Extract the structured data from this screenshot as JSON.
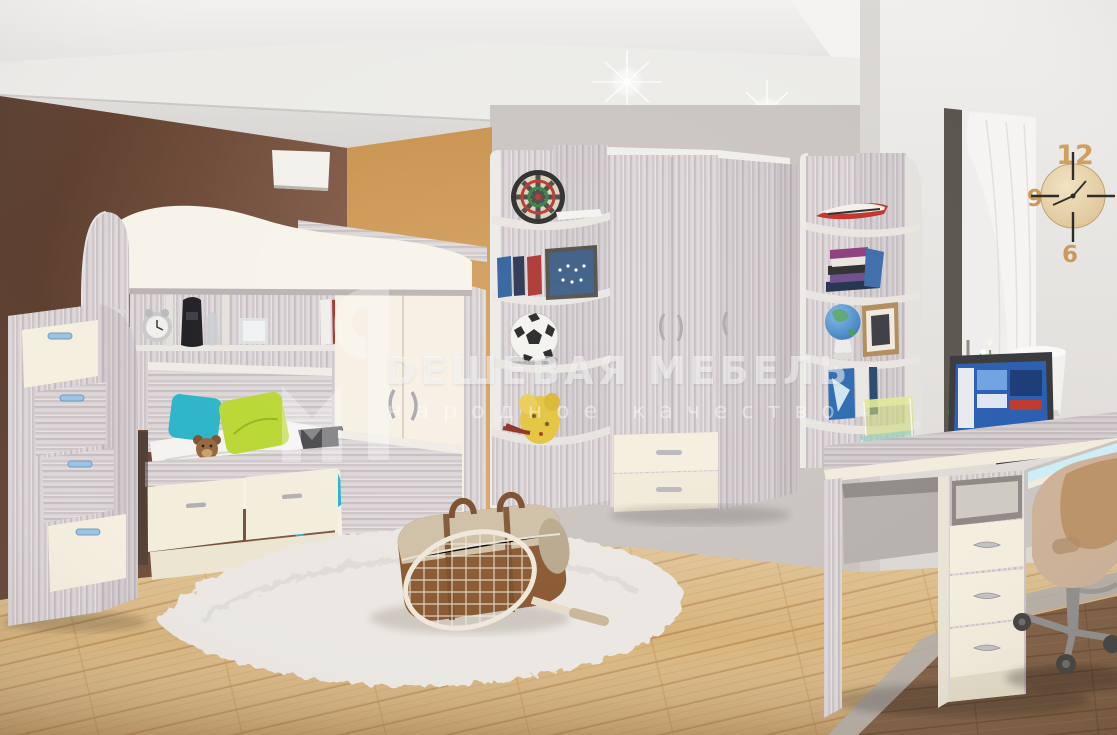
{
  "watermark": {
    "brand": "DЕШЕВАЯ МЕБЕЛЬ",
    "tagline": "народное качество"
  },
  "clock": {
    "numerals": [
      "12",
      "9",
      "6"
    ]
  },
  "colors": {
    "wall_brown": "#6d4a37",
    "wall_orange": "#d29a55",
    "wall_light": "#e9e7e4",
    "ceiling": "#e5e3e0",
    "furniture_ash": "#d9d3d4",
    "furniture_cream": "#f3eedd",
    "floor_wood": "#d8b47b",
    "floor_dark": "#7d5c40",
    "rug": "#ebe8e4",
    "pillow_green": "#b9d733",
    "textile_teal": "#2ab3c6",
    "laptop_red": "#c0392b",
    "handle_blue": "#9cc3e2",
    "watermark": "rgba(255,255,255,0.5)"
  }
}
